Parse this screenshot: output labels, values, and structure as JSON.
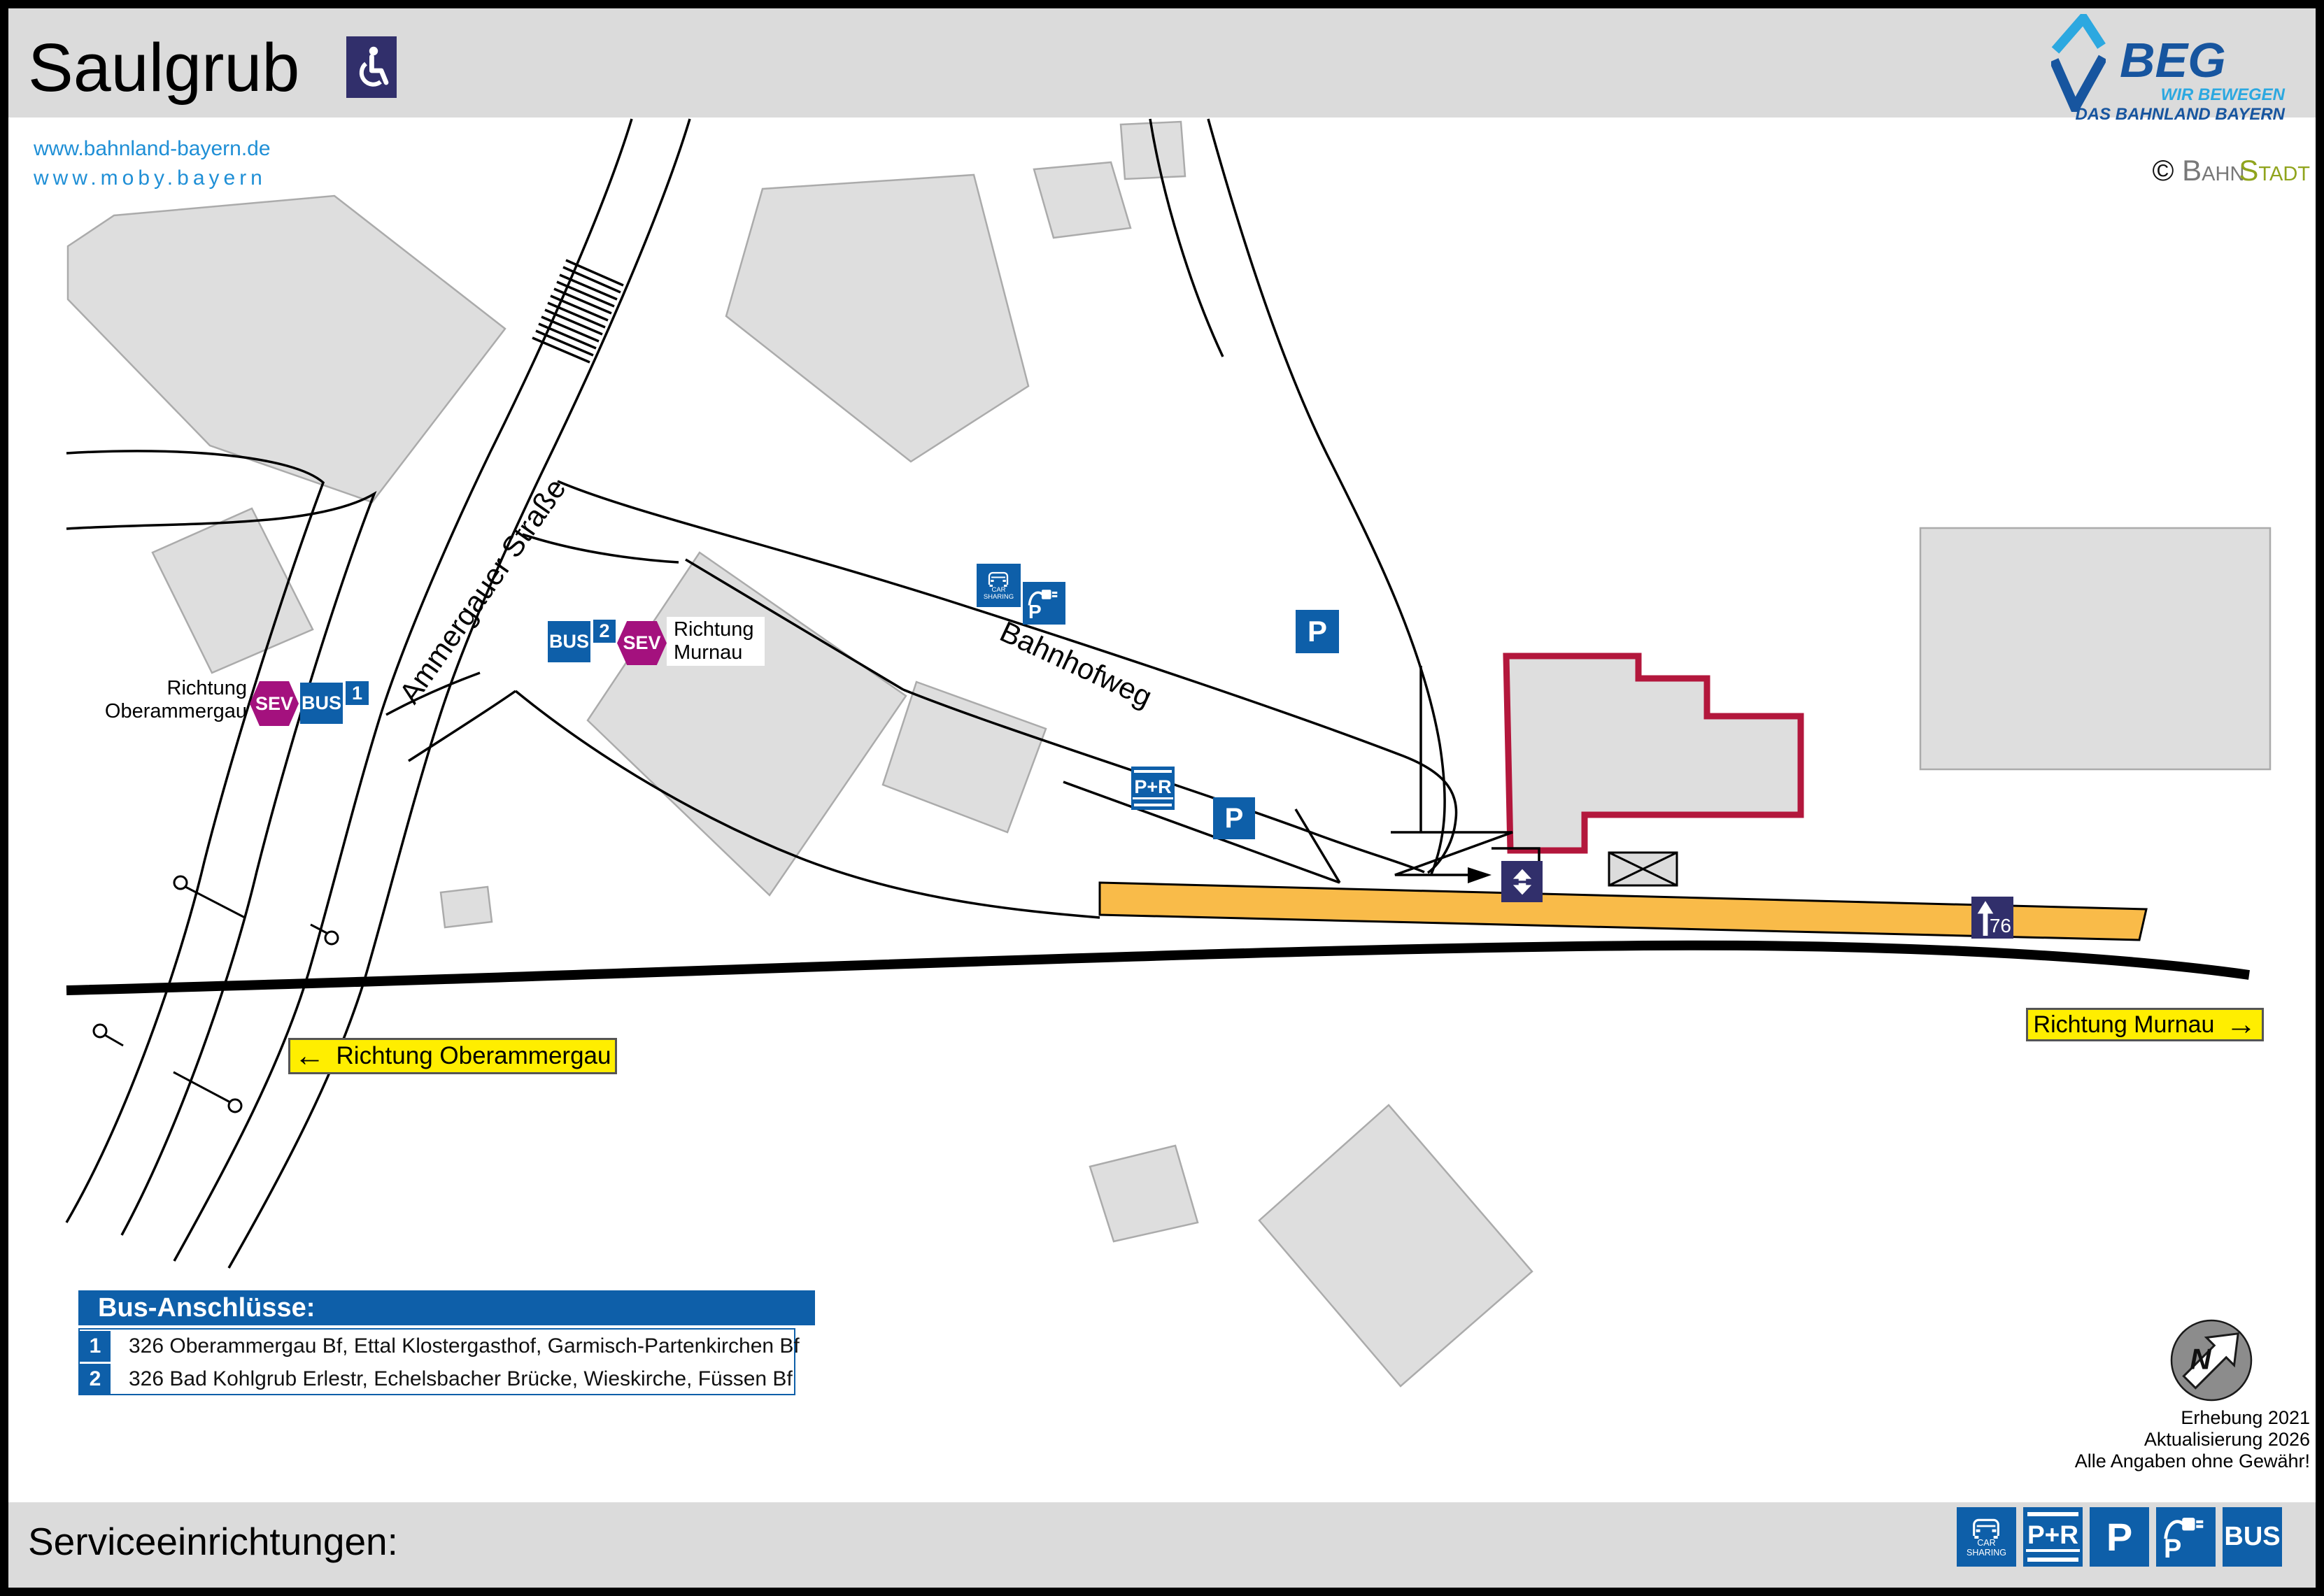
{
  "header": {
    "title": "Saulgrub"
  },
  "links": {
    "site1": "www.bahnland-bayern.de",
    "site2": "www.moby.bayern"
  },
  "branding": {
    "beg": "BEG",
    "tagline1": "WIR BEWEGEN",
    "tagline2": "DAS BAHNLAND BAYERN",
    "copyright": "©",
    "brand_part1": "Bahn",
    "brand_part2": "Stadt"
  },
  "map": {
    "street1": "Ammergauer Straße",
    "street2": "Bahnhofweg",
    "stop1": {
      "dir1": "Richtung",
      "dir2": "Oberammergau",
      "sev": "SEV",
      "bus": "BUS",
      "num": "1"
    },
    "stop2": {
      "dir1": "Richtung",
      "dir2": "Murnau",
      "sev": "SEV",
      "bus": "BUS",
      "num": "2"
    },
    "sign_west": {
      "arrow": "←",
      "text": "Richtung Oberammergau"
    },
    "sign_east": {
      "arrow": "→",
      "text": "Richtung Murnau"
    },
    "platform_height": "76",
    "north": "N"
  },
  "icons": {
    "car": "CAR",
    "sharing": "SHARING",
    "pr": "P+R",
    "p": "P",
    "bus": "BUS"
  },
  "legend": {
    "title": "Bus-Anschlüsse:",
    "rows": [
      {
        "num": "1",
        "text": "326 Oberammergau Bf, Ettal Klostergasthof, Garmisch-Partenkirchen Bf"
      },
      {
        "num": "2",
        "text": "326 Bad Kohlgrub Erlestr, Echelsbacher Brücke, Wieskirche, Füssen Bf"
      }
    ]
  },
  "meta": {
    "line1": "Erhebung 2021",
    "line2": "Aktualisierung 2026",
    "line3": "Alle Angaben ohne Gewähr!"
  },
  "footer": {
    "title": "Serviceeinrichtungen:"
  },
  "colors": {
    "blue": "#0E5FA9",
    "navy": "#312F6B",
    "magenta": "#A4117E",
    "platform_orange": "#F9BB49",
    "highlight_red": "#B3173C",
    "sign_yellow": "#FFEE00",
    "link_blue": "#1F8FD6",
    "beg_dark_blue": "#17559F",
    "beg_light_blue": "#2CA8E0",
    "bahnstadt_green": "#90A41D"
  }
}
